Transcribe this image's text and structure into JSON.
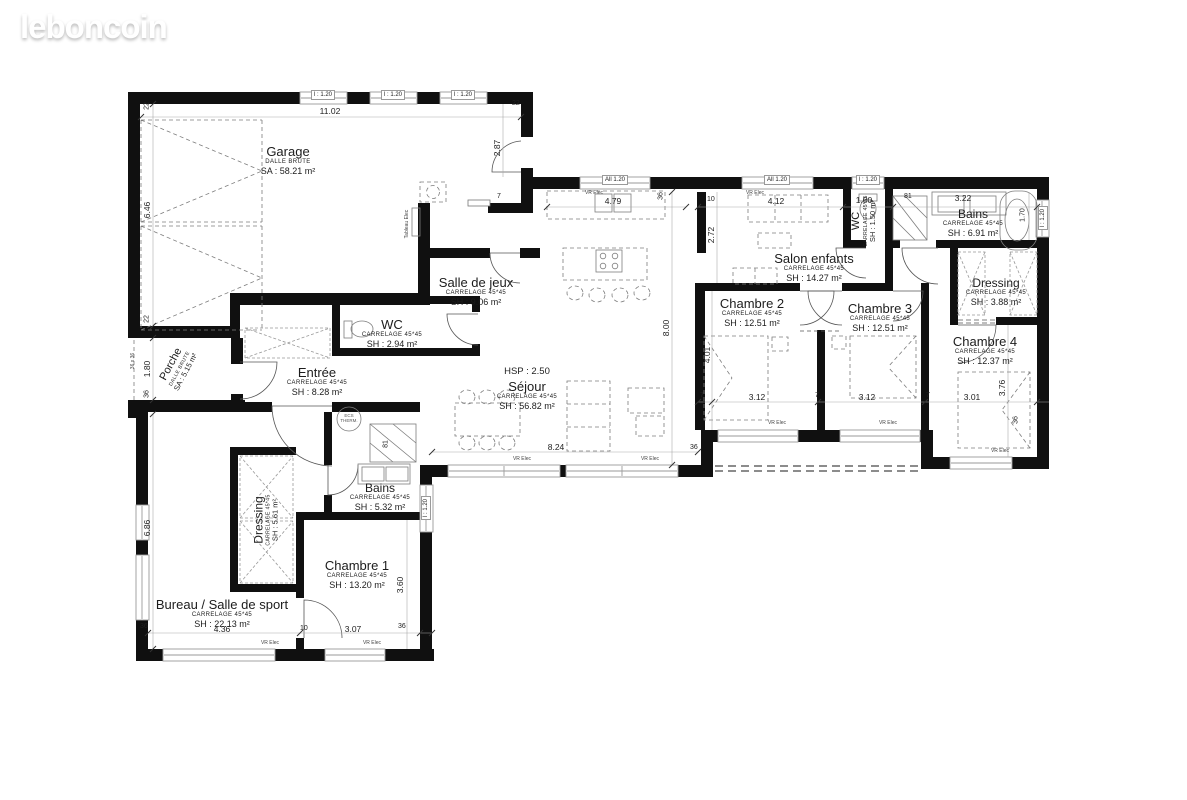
{
  "logo": {
    "text": "leboncoin"
  },
  "rooms": {
    "garage": {
      "name": "Garage",
      "finish": "DALLE  BRUTE",
      "area": "SA : 58.21 m²"
    },
    "porche": {
      "name": "Porche",
      "finish": "DALLE BRUTE",
      "area": "SA : 5.15 m²"
    },
    "salle_de_jeux": {
      "name": "Salle de jeux",
      "finish": "CARRELAGE  45*45",
      "area": "SH : 9.06 m²"
    },
    "wc_jour": {
      "name": "WC",
      "finish": "CARRELAGE  45*45",
      "area": "SH : 2.94 m²"
    },
    "entree": {
      "name": "Entrée",
      "finish": "CARRELAGE  45*45",
      "area": "SH : 8.28 m²"
    },
    "sejour": {
      "name": "Séjour",
      "finish": "CARRELAGE  45*45",
      "area": "SH : 56.82 m²",
      "hsp": "HSP : 2.50"
    },
    "salon_enfants": {
      "name": "Salon enfants",
      "finish": "CARRELAGE  45*45",
      "area": "SH : 14.27 m²"
    },
    "wc_nuit": {
      "name": "WC",
      "finish": "CARRELAGE  45*45",
      "area": "SH : 1.50 m²"
    },
    "bains_nuit": {
      "name": "Bains",
      "finish": "CARRELAGE  45*45",
      "area": "SH : 6.91 m²"
    },
    "dressing_nuit": {
      "name": "Dressing",
      "finish": "CARRELAGE  45*45",
      "area": "SH : 3.88 m²"
    },
    "chambre2": {
      "name": "Chambre 2",
      "finish": "CARRELAGE  45*45",
      "area": "SH : 12.51 m²"
    },
    "chambre3": {
      "name": "Chambre 3",
      "finish": "CARRELAGE  45*45",
      "area": "SH : 12.51 m²"
    },
    "chambre4": {
      "name": "Chambre 4",
      "finish": "CARRELAGE  45*45",
      "area": "SH : 12.37 m²"
    },
    "bureau": {
      "name": "Bureau / Salle de sport",
      "finish": "CARRELAGE  45*45",
      "area": "SH : 22.13 m²"
    },
    "chambre1": {
      "name": "Chambre 1",
      "finish": "CARRELAGE  45*45",
      "area": "SH : 13.20 m²"
    },
    "dressing_jour": {
      "name": "Dressing",
      "finish": "CARRELAGE  45*45",
      "area": "SH : 5.61 m²"
    },
    "bains_jour": {
      "name": "Bains",
      "finish": "CARRELAGE  45*45",
      "area": "SH : 5.32 m²"
    }
  },
  "dims": {
    "garage_width": "11.02",
    "garage_depth": "6.46",
    "entry_step": "2.87",
    "kitchen_bay": "4.79",
    "salon_bay": "4.12",
    "wc_width": "1.00",
    "bath_counter": "3.22",
    "salon_depth": "2.72",
    "sejour_width": "8.24",
    "sejour_depth": "8.00",
    "ch2_width": "3.12",
    "ch3_width": "3.12",
    "ch4_width": "3.01",
    "ch2_depth": "4.01",
    "ch4_depth": "3.76",
    "ch1_depth": "3.60",
    "ch1_width": "3.07",
    "bureau_width": "4.36",
    "bureau_depth": "6.86",
    "porche_depth": "1.80",
    "tub_length": "1.70",
    "t22": "22",
    "t36": "36",
    "t10": "10",
    "t7": "7",
    "t81": "81",
    "post": "36 x 36"
  },
  "window_labels": {
    "single": "l : 1.20",
    "double": "All 1.20"
  },
  "ann": {
    "vr": "VR Elec",
    "tableau": "Tableau Elec",
    "ecs": "ECS THERM."
  }
}
